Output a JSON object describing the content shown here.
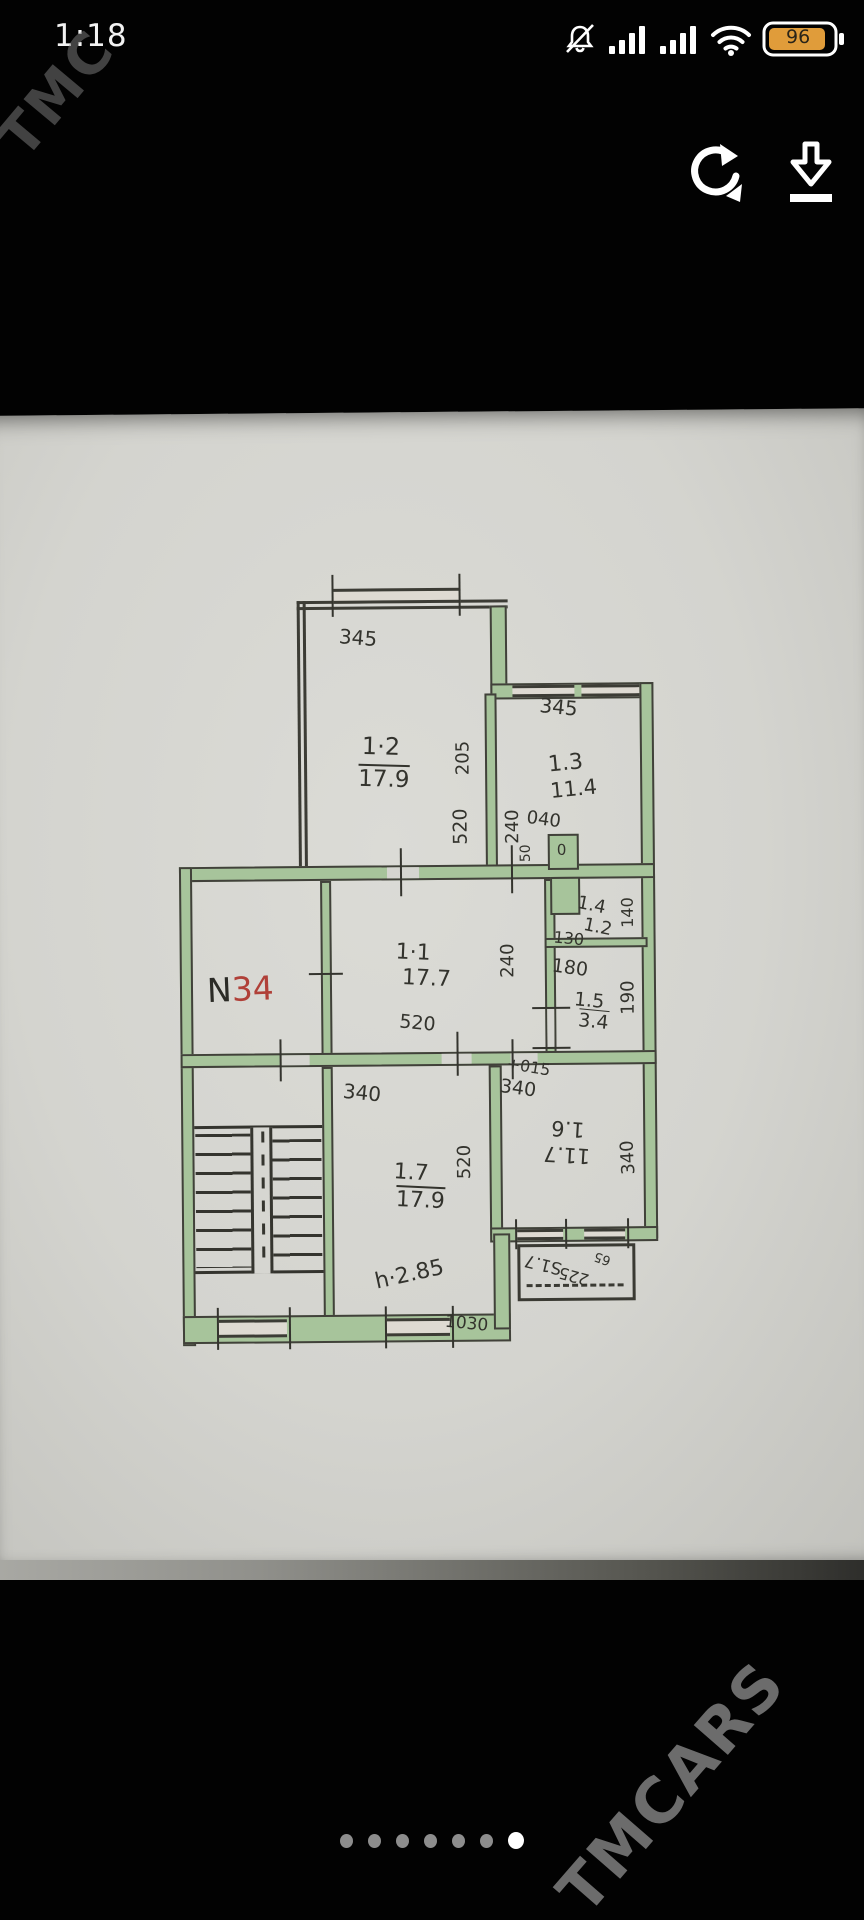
{
  "status_bar": {
    "time": "1:18",
    "battery_percent": "96",
    "icons": [
      "mute-icon",
      "cellular-signal-icon",
      "cellular-signal-icon",
      "wifi-icon",
      "battery-icon"
    ]
  },
  "toolbar": {
    "rotate_icon": "rotate-refresh",
    "download_icon": "download"
  },
  "watermarks": {
    "top_left": "TMC",
    "bottom_right": "TMCARS"
  },
  "floor_plan": {
    "unit_number": {
      "prefix": "N",
      "number": "34"
    },
    "rooms": {
      "r11": {
        "id": "1·1",
        "area": "17.7"
      },
      "r12": {
        "id": "1·2",
        "area": "17.9"
      },
      "r13": {
        "id": "1.3",
        "area": "11.4"
      },
      "r14": {
        "id": "1.4",
        "area": "1.2"
      },
      "r15": {
        "id": "1.5",
        "area": "3.4"
      },
      "r16": {
        "id": "1.6",
        "area": "11.7"
      },
      "r17": {
        "id": "1.7",
        "area": "17.9"
      }
    },
    "labels": {
      "dim_top_left": "345",
      "dim_top_right": "345",
      "dim_205": "205",
      "dim_520a": "520",
      "dim_240a": "240",
      "duct_width": "040",
      "duct_height": "50",
      "duct_zero": "0",
      "dim_140": "140",
      "dim_130": "130",
      "dim_180": "180",
      "dim_190": "190",
      "dim_240b": "240",
      "dim_520b": "520",
      "dim_015": "+015",
      "dim_340a": "340",
      "dim_340b": "340",
      "dim_340c": "340",
      "dim_520c": "520",
      "dim_bottom": "1030",
      "height_note": "h·2.85",
      "balcony_area": "S1.7",
      "balcony_width": "225",
      "balcony_depth": "65"
    }
  },
  "pagination": {
    "count": 7,
    "active_index": 6
  }
}
